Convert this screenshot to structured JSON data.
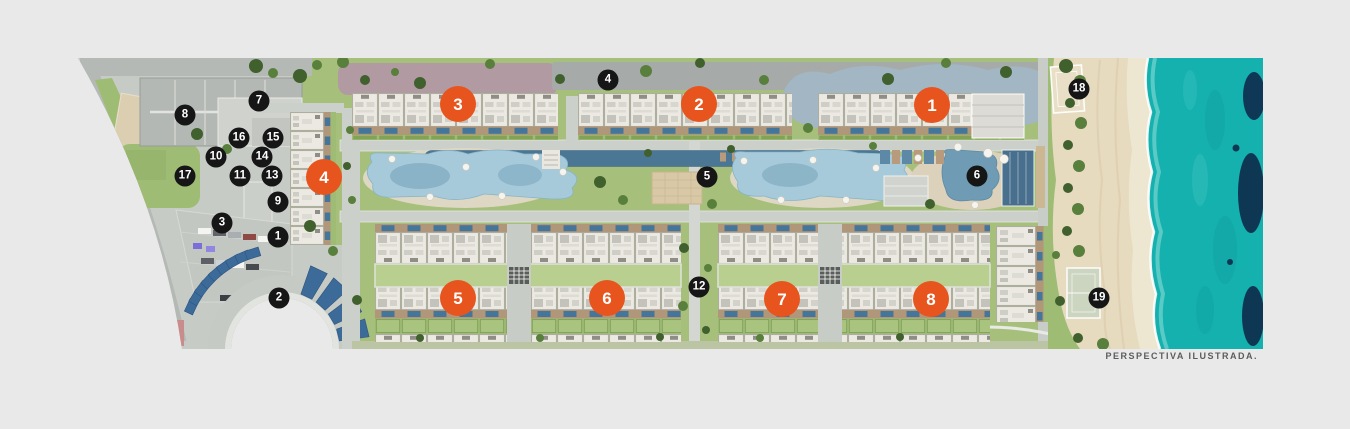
{
  "canvas": {
    "width": 1350,
    "height": 429,
    "background": "#e9e9e9"
  },
  "caption": {
    "text": "PERSPECTIVA ILUSTRADA.",
    "color": "#5c5c5c"
  },
  "markers": {
    "building_color": "#e8541d",
    "amenity_color": "#161616",
    "text_color": "#ffffff",
    "buildings": [
      {
        "number": "1",
        "x": 932,
        "y": 105
      },
      {
        "number": "2",
        "x": 699,
        "y": 104
      },
      {
        "number": "3",
        "x": 458,
        "y": 104
      },
      {
        "number": "4",
        "x": 324,
        "y": 177
      },
      {
        "number": "5",
        "x": 458,
        "y": 298
      },
      {
        "number": "6",
        "x": 607,
        "y": 298
      },
      {
        "number": "7",
        "x": 782,
        "y": 299
      },
      {
        "number": "8",
        "x": 931,
        "y": 299
      }
    ],
    "amenities": [
      {
        "number": "1",
        "x": 278,
        "y": 237
      },
      {
        "number": "2",
        "x": 279,
        "y": 298
      },
      {
        "number": "3",
        "x": 222,
        "y": 223
      },
      {
        "number": "4",
        "x": 608,
        "y": 80
      },
      {
        "number": "5",
        "x": 707,
        "y": 177
      },
      {
        "number": "6",
        "x": 977,
        "y": 176
      },
      {
        "number": "7",
        "x": 259,
        "y": 101
      },
      {
        "number": "8",
        "x": 185,
        "y": 115
      },
      {
        "number": "9",
        "x": 278,
        "y": 202
      },
      {
        "number": "10",
        "x": 216,
        "y": 157
      },
      {
        "number": "11",
        "x": 240,
        "y": 176
      },
      {
        "number": "12",
        "x": 699,
        "y": 287
      },
      {
        "number": "13",
        "x": 272,
        "y": 176
      },
      {
        "number": "14",
        "x": 262,
        "y": 157
      },
      {
        "number": "15",
        "x": 273,
        "y": 138
      },
      {
        "number": "16",
        "x": 239,
        "y": 138
      },
      {
        "number": "17",
        "x": 185,
        "y": 176
      },
      {
        "number": "18",
        "x": 1079,
        "y": 89
      },
      {
        "number": "19",
        "x": 1099,
        "y": 298
      }
    ]
  },
  "colors": {
    "grass": "#a6c07b",
    "grass_light": "#b8cf8f",
    "hedge": "#82a356",
    "road": "#ccd0cb",
    "road_dark": "#a6abaa",
    "roof": "#ebe9e2",
    "patio_tan": "#b1977a",
    "plunge_pool": "#44759b",
    "pool_light": "#a6cada",
    "pool_dark": "#4b7794",
    "lagoon": "#a2b6c3",
    "mauve": "#b29aa3",
    "sand": "#e6dabf",
    "sea": "#15b1af",
    "sea_deep": "#0e3150",
    "canopy_blue": "#3c6a99",
    "tree_dark": "#40602e",
    "tree_mid": "#597f3c"
  }
}
